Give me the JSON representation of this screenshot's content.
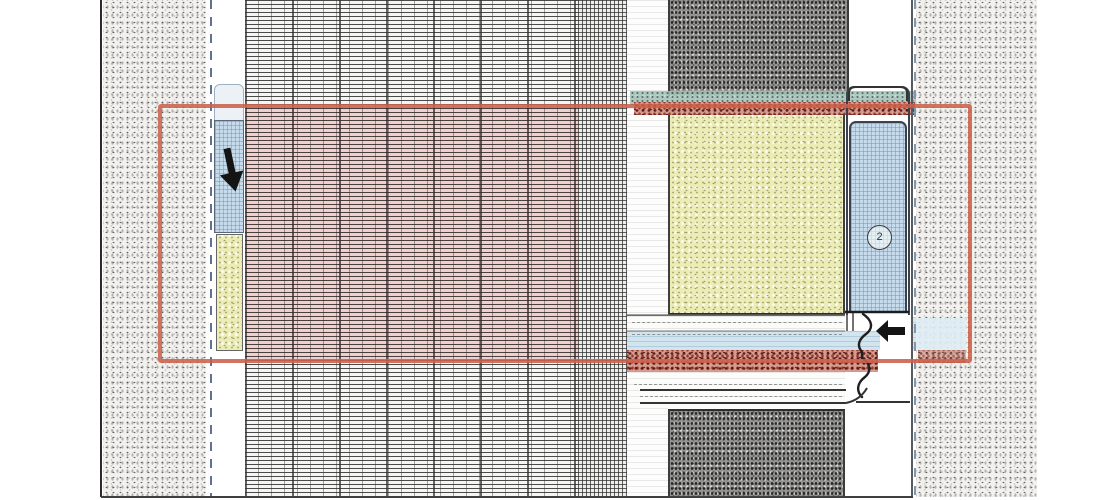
{
  "drawing": {
    "kind": "facade-panel-joint-section-detail",
    "detail_marker": {
      "label": "2"
    },
    "highlight": {
      "box_color": "#cb614c",
      "insulation_tint": "rgba(233,120,110,0.28)"
    },
    "annotations": {
      "arrows": [
        {
          "name": "down-arrow",
          "direction": "down"
        },
        {
          "name": "left-arrow",
          "direction": "left"
        }
      ]
    },
    "materials": {
      "outer_wall_stipple": "#f2f1ee",
      "dark_infill_block": "#949392",
      "insulation_board_yellow": "#ececb6",
      "frame_panel_blue": "#c6dcec",
      "gasket_teal": "#a6c4ba",
      "sealant_red": "#8a2c22",
      "joint_band_blue": "#d2e4ee",
      "hatch_line": "#2d2d2d"
    }
  }
}
